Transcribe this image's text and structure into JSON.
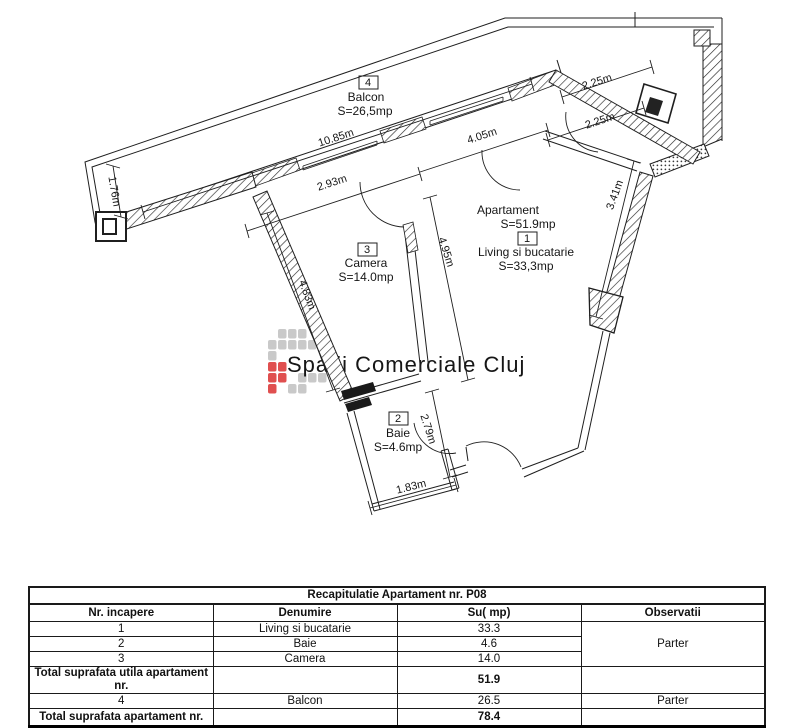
{
  "plan": {
    "rooms": {
      "balcon": {
        "no": "4",
        "name": "Balcon",
        "area": "S=26,5mp"
      },
      "apart": {
        "title": "Apartament",
        "area": "S=51.9mp"
      },
      "living": {
        "no": "1",
        "name": "Living si bucatarie",
        "area": "S=33,3mp"
      },
      "camera": {
        "no": "3",
        "name": "Camera",
        "area": "S=14.0mp"
      },
      "baie": {
        "no": "2",
        "name": "Baie",
        "area": "S=4.6mp"
      }
    },
    "dimensions": {
      "d1085": "10.85m",
      "d293": "2.93m",
      "d405": "4.05m",
      "d225a": "2.25m",
      "d225b": "2.25m",
      "d176": "1.76m",
      "d483": "4.83m",
      "d495": "4.95m",
      "d279": "2.79m",
      "d341": "3.41m",
      "d183": "1.83m"
    },
    "watermark": {
      "text": "Spatii Comerciale Cluj",
      "gray": "#c9c9c9",
      "red": "#e04f4f",
      "logo_grid": [
        ".GGG..",
        "GGGGG.",
        "G.....",
        "RR....",
        "RR.GGG",
        "R.GG.."
      ]
    },
    "ink": "#1f1f1f"
  },
  "table": {
    "title": "Recapitulatie Apartament nr. P08",
    "headers": {
      "nr": "Nr. incapere",
      "den": "Denumire",
      "su": "Su( mp)",
      "obs": "Observatii"
    },
    "rows": [
      {
        "nr": "1",
        "den": "Living si bucatarie",
        "su": "33.3"
      },
      {
        "nr": "2",
        "den": "Baie",
        "su": "14.0-placeholder"
      },
      {
        "nr": "3",
        "den": "Camera",
        "su": "14.0"
      }
    ],
    "row2_su": "4.6",
    "obs_merged": "Parter",
    "total_utila": {
      "label": "Total suprafata utila apartament nr.",
      "su": "51.9"
    },
    "row4": {
      "nr": "4",
      "den": "Balcon",
      "su": "26.5",
      "obs": "Parter"
    },
    "total": {
      "label": "Total suprafata apartament nr.",
      "su": "78.4"
    }
  }
}
